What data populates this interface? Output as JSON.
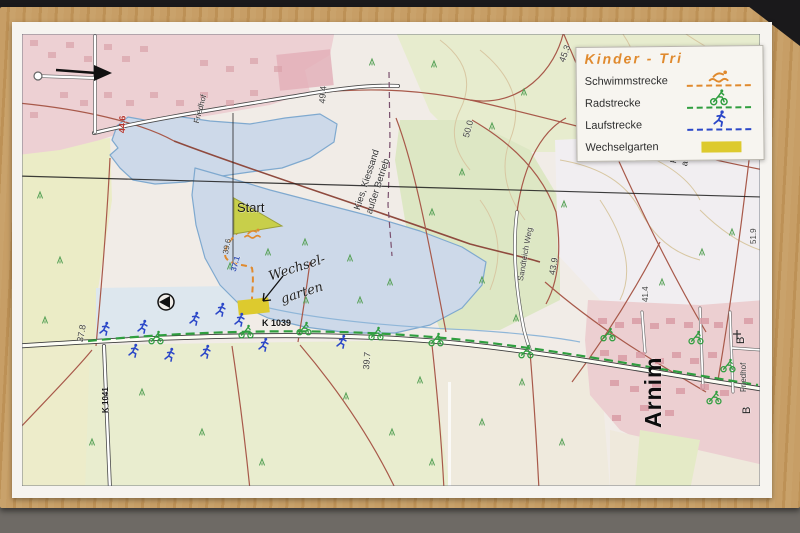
{
  "legend": {
    "title": "Kinder - Tri",
    "items": [
      {
        "label": "Schwimmstrecke",
        "icon": "swimmer-icon",
        "color": "#e08a2e"
      },
      {
        "label": "Radstrecke",
        "icon": "cyclist-icon",
        "color": "#2f9e3f"
      },
      {
        "label": "Laufstrecke",
        "icon": "runner-icon",
        "color": "#2b47c8"
      },
      {
        "label": "Wechselgarten",
        "icon": "area-swatch",
        "color": "#ddca2e"
      }
    ]
  },
  "map": {
    "labels": {
      "start": "Start",
      "wechselgarten_line1": "Wechsel-",
      "wechselgarten_line2": "garten",
      "kies_center_l1": "Kies, Kiessand",
      "kies_center_l2": "außer Betrieb",
      "kies_right_l1": "Kies, Ki",
      "kies_right_l2": "außer B",
      "arnim": "Arnim",
      "friedhof_nw": "Friedhof",
      "friedhof_e": "Friedhof",
      "road_k1039": "K 1039",
      "road_k1041": "K 1041",
      "road_sandteich": "Sandteich Weg"
    },
    "elevations": {
      "e_446": "44.6",
      "e_494": "49.4",
      "e_500": "50.0",
      "e_453": "45.3",
      "e_439": "43.9",
      "e_414": "41.4",
      "e_519": "51.9",
      "e_396": "39.6",
      "e_371": "37.1",
      "e_397": "39.7",
      "e_378": "37.8",
      "b_road_1": "B",
      "b_road_2": "B"
    },
    "colors": {
      "swim": "#e08a2e",
      "bike": "#2f9e3f",
      "run": "#2b47c8",
      "transition": "#ddca2e",
      "lake": "#cdd9e9"
    }
  }
}
